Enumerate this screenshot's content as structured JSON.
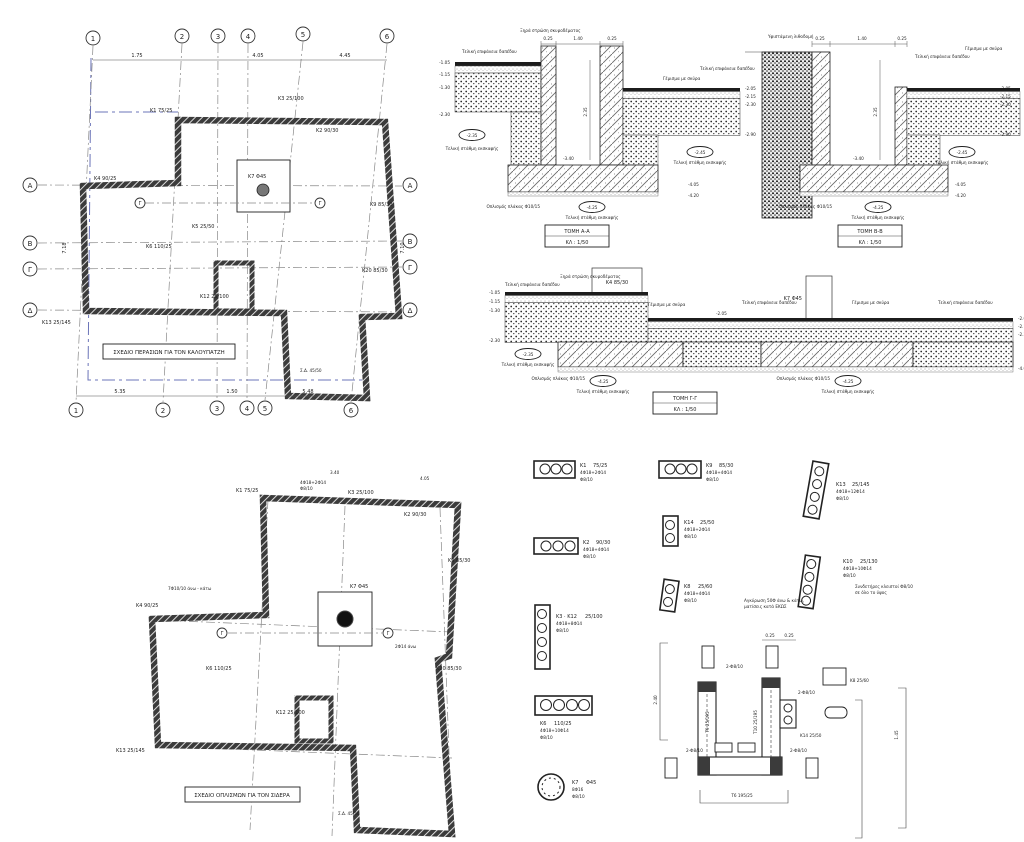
{
  "sheet": {
    "bg": "#ffffff",
    "ink": "#1f1f1f",
    "boundary_blue": "#6b74b8"
  },
  "terms": {
    "scale": "ΚΛ : 1/50",
    "excav": "Τελική στάθμη εκσκαφής",
    "slab": "Οπλισμός πλάκας Φ10/15",
    "floor": "Τελική επιφάνεια δαπέδου",
    "fill": "Γέμισμα με σκύρα",
    "drycrete": "Ξηρά στρώση σκυροδέματος",
    "oldwall": "Υφιστάμενη λιθοδομή"
  },
  "plan_formwork": {
    "title": "ΣΧΕΔΙΟ ΠΕΡΑΣΙΩΝ ΓΙΑ ΤΟΝ ΚΑΛΟΥΠΑΤΖΗ",
    "cols": [
      "1",
      "2",
      "3",
      "4",
      "5",
      "6"
    ],
    "rows": [
      "Α",
      "Β",
      "Γ",
      "Δ"
    ],
    "dims_top": [
      "1.75",
      "4.05",
      "4.45"
    ],
    "dims_bottom": [
      "5.35",
      "1.50",
      "5.48"
    ],
    "dim_left": "7.18",
    "dim_right": "7.10",
    "note": "Σ.Δ. 45/50",
    "section_mark": "Γ",
    "columns": [
      "Κ1 75/25",
      "Κ2 90/30",
      "Κ3 25/100",
      "Κ4 90/25",
      "Κ5 25/50",
      "Κ6 110/25",
      "Κ7 Φ45",
      "Κ9 85/30",
      "Κ12 25/100",
      "Κ13 25/145",
      "Κ20 85/30"
    ]
  },
  "plan_rebar": {
    "title": "ΣΧΕΔΙΟ ΟΠΛΙΣΜΩΝ ΓΙΑ ΤΟΝ ΣΙΔΕΡΑ",
    "note": "Σ.Δ. 45/50",
    "section_mark": "Γ",
    "dims_top": [
      "3.40",
      "4.05"
    ],
    "callouts": [
      "4Φ18+2Φ14",
      "Φ8/10",
      "7Φ10/10 άνω - κάτω",
      "2Φ14 άνω"
    ],
    "columns": [
      "Κ1 75/25",
      "Κ3 25/100",
      "Κ2 90/30",
      "Κ9 85/30",
      "Κ7 Φ45",
      "Κ4 90/25",
      "Κ13 25/145",
      "Κ20 85/30",
      "Κ6 110/25",
      "Κ12 25/100"
    ]
  },
  "section_a": {
    "title": "ΤΟΜΗ Α-Α",
    "dims_top": [
      "0.25",
      "1.40",
      "0.25"
    ],
    "pit_depth": "2.35",
    "elev_left": [
      "-1.05",
      "-1.15",
      "-1.30",
      "-2.30"
    ],
    "oval_left": "-2.35",
    "pit_floor": "-3.40",
    "elev_right": [
      "-2.05",
      "-2.15",
      "-2.30",
      "-2.90"
    ],
    "oval_right": "-2.45",
    "elev_bottom": [
      "-4.05",
      "-4.20"
    ],
    "oval_bottom": "-4.25"
  },
  "section_b": {
    "title": "ΤΟΜΗ Β-Β",
    "dims_top": [
      "0.25",
      "1.40",
      "0.25"
    ],
    "pit_depth": "2.35",
    "elev_right": [
      "-2.05",
      "-2.15",
      "-2.30",
      "-2.90"
    ],
    "oval_right": "-2.45",
    "pit_floor": "-3.40",
    "elev_bottom": [
      "-4.05",
      "-4.20"
    ],
    "oval_bottom": "-4.25"
  },
  "section_c": {
    "title": "ΤΟΜΗ Γ-Γ",
    "k4": "Κ4 85/30",
    "k7": "Κ7 Φ45",
    "elev_left": [
      "-1.05",
      "-1.15",
      "-1.30",
      "-2.30"
    ],
    "oval_left": "-2.35",
    "elev_mid": "-2.05",
    "elev_right": [
      "-2.05",
      "-2.15",
      "-2.30"
    ],
    "elev_right_low": "-4.05",
    "ovals_bottom": [
      "-4.25",
      "-4.25"
    ]
  },
  "col_sections": [
    {
      "name": "Κ1",
      "size": "75/25",
      "bars": "4Φ18+2Φ14",
      "ties": "Φ8/10"
    },
    {
      "name": "Κ9",
      "size": "85/30",
      "bars": "4Φ18+4Φ14",
      "ties": "Φ8/10"
    },
    {
      "name": "Κ13",
      "size": "25/145",
      "bars": "4Φ18+12Φ14",
      "ties": "Φ8/10"
    },
    {
      "name": "Κ2",
      "size": "90/30",
      "bars": "4Φ18+4Φ14",
      "ties": "Φ8/10"
    },
    {
      "name": "Κ14",
      "size": "25/50",
      "bars": "4Φ18+2Φ14",
      "ties": "Φ8/10"
    },
    {
      "name": "Κ10",
      "size": "25/130",
      "bars": "4Φ18+10Φ14",
      "ties": "Φ8/10"
    },
    {
      "name": "Κ3 · Κ12",
      "size": "25/100",
      "bars": "4Φ18+8Φ14",
      "ties": "Φ8/10"
    },
    {
      "name": "Κ8",
      "size": "25/60",
      "bars": "4Φ18+4Φ14",
      "ties": "Φ8/10"
    },
    {
      "name": "Κ6",
      "size": "110/25",
      "bars": "4Φ18+10Φ14",
      "ties": "Φ8/10"
    },
    {
      "name": "Κ7",
      "size": "Φ45",
      "bars": "8Φ16",
      "ties": "Φ8/10"
    }
  ],
  "col_notes": [
    "Αγκύρωση 50Φ άνω & κάτω,",
    "ματίσεις κατά ΕΚΩΣ",
    "Συνδετήρες κλειστοί Φ8/10",
    "σε όλο το ύψος"
  ],
  "shaft": {
    "t9": "Τ9  25/195",
    "t10": "Τ10  25/195",
    "t6": "Τ6  195/25",
    "k8": "Κ8  25/60",
    "k14": "Κ14  25/50",
    "ties": "2-Φ8/10",
    "dim_a": "0.25",
    "dim_b": "0.25",
    "dim_c": "1.45",
    "dim_d": "2.40"
  }
}
